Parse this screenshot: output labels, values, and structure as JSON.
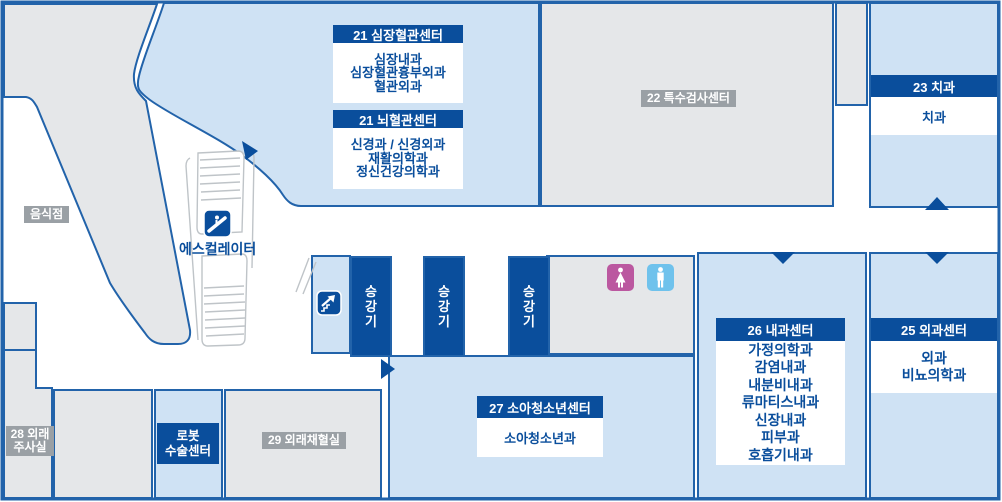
{
  "floor_map": {
    "centers": [
      {
        "title": "21 심장혈관센터",
        "depts": [
          "심장내과",
          "심장혈관흉부외과",
          "혈관외과"
        ]
      },
      {
        "title": "21 뇌혈관센터",
        "depts": [
          "신경과 / 신경외과",
          "재활의학과",
          "정신건강의학과"
        ]
      },
      {
        "title": "23 치과",
        "depts": [
          "치과"
        ]
      },
      {
        "title": "26 내과센터",
        "depts": [
          "가정의학과",
          "감염내과",
          "내분비내과",
          "류마티스내과",
          "신장내과",
          "피부과",
          "호흡기내과"
        ]
      },
      {
        "title": "25 외과센터",
        "depts": [
          "외과",
          "비뇨의학과"
        ]
      },
      {
        "title": "27 소아청소년센터",
        "depts": [
          "소아청소년과"
        ]
      }
    ],
    "rooms": {
      "special_exam": "22 특수검사센터",
      "restaurant": "음식점",
      "blood_collection": "29 외래채혈실",
      "injection_line1": "28 외래",
      "injection_line2": "주사실",
      "robot_line1": "로봇",
      "robot_line2": "수술센터"
    },
    "facilities": {
      "escalator_label": "에스컬레이터",
      "elevator_char_1": "승",
      "elevator_char_2": "강",
      "elevator_char_3": "기"
    },
    "icons": [
      "escalator-icon",
      "stairs-up-icon",
      "female-restroom-icon",
      "male-restroom-icon",
      "entrance-arrow"
    ],
    "colors": {
      "dark_blue": "#0a4e9c",
      "border_blue": "#2263aa",
      "light_blue": "#cfe2f4",
      "area_gray": "#e5e7e9",
      "badge_gray": "#9aa0a5",
      "female_pink": "#bb58a0",
      "male_blue": "#6fc2ec"
    }
  }
}
